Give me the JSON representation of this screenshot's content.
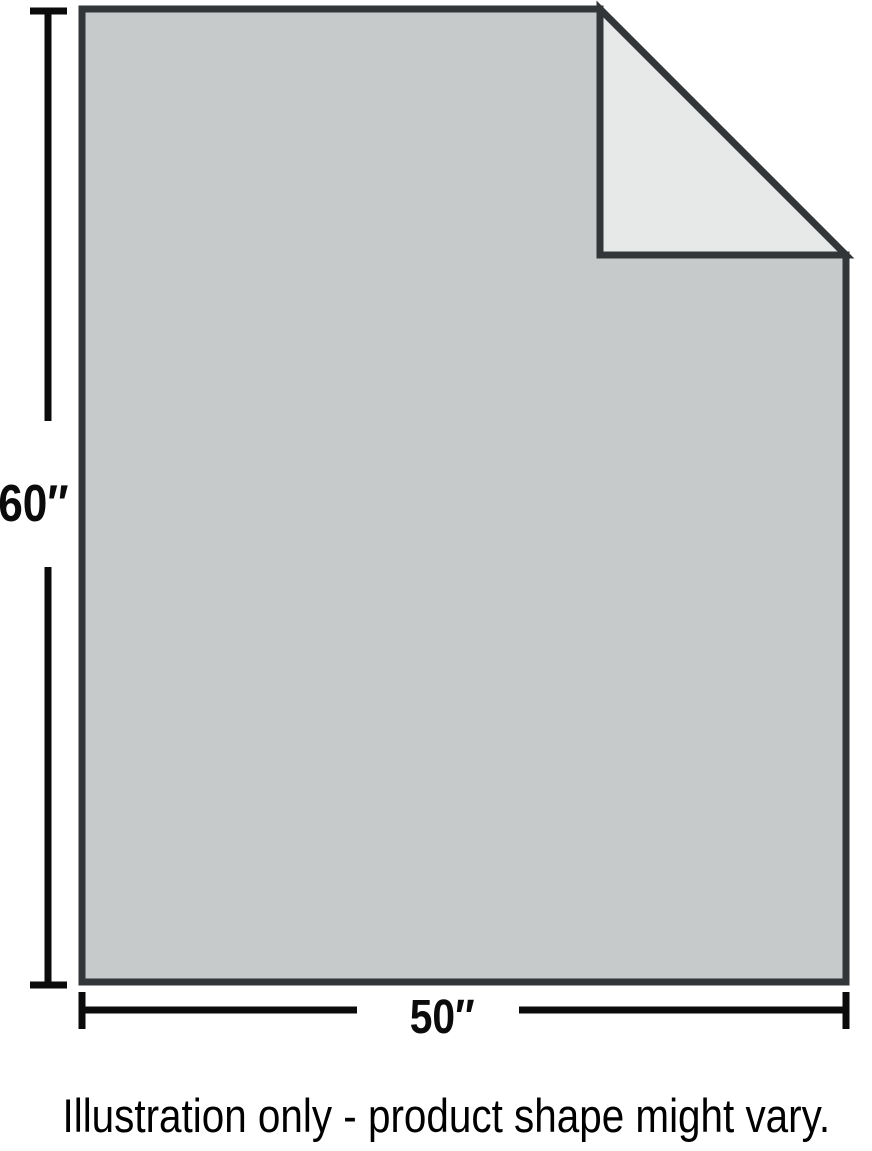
{
  "diagram": {
    "height_dimension": "60″",
    "width_dimension": "50″",
    "caption": "Illustration only - product shape might vary."
  },
  "colors": {
    "sheet_fill": "#c7caca",
    "fold_fill": "#e7e9e9",
    "outline": "#333638",
    "dimension_line": "#0b0b0b",
    "caption_text": "#000000"
  }
}
